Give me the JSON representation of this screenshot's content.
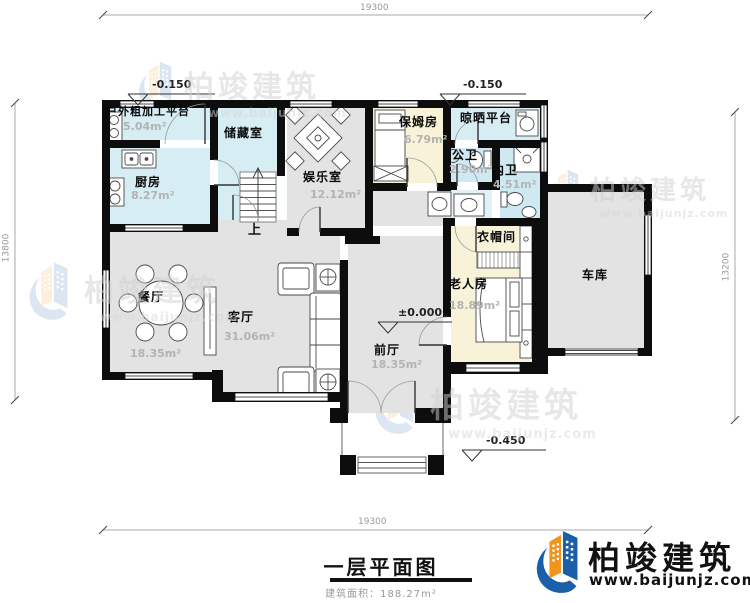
{
  "drawing": {
    "title": "一层平面图",
    "area_note": "建筑面积：188.27m²",
    "stairs_label": "上"
  },
  "dimensions": {
    "top": "19300",
    "bottom": "19300",
    "left": "13800",
    "right": "13200"
  },
  "levels": {
    "top_left": "-0.150",
    "top_right": "-0.150",
    "entry": "±0.000",
    "porch": "-0.450"
  },
  "rooms": [
    {
      "name": "户外粗加工平台",
      "area": "5.04m²"
    },
    {
      "name": "厨房",
      "area": "8.27m²"
    },
    {
      "name": "储藏室",
      "area": ""
    },
    {
      "name": "娱乐室",
      "area": "12.12m²"
    },
    {
      "name": "保姆房",
      "area": "6.79m²"
    },
    {
      "name": "晾晒平台",
      "area": ""
    },
    {
      "name": "公卫",
      "area": "2.90m²"
    },
    {
      "name": "内卫",
      "area": "4.51m²"
    },
    {
      "name": "衣帽间",
      "area": ""
    },
    {
      "name": "老人房",
      "area": "18.89m²"
    },
    {
      "name": "车库",
      "area": ""
    },
    {
      "name": "餐厅",
      "area": "18.35m²"
    },
    {
      "name": "客厅",
      "area": "31.06m²"
    },
    {
      "name": "前厅",
      "area": "18.35m²"
    }
  ],
  "brand": {
    "name": "柏竣建筑",
    "url": "www.baijunjz.com",
    "blue": "#1a5fa8",
    "orange": "#f0941d"
  },
  "colors": {
    "wall": "#0d0d0d",
    "room_gray": "#e3e3e3",
    "room_cyan": "#d6edf4",
    "room_yellow": "#f8f2d8"
  }
}
